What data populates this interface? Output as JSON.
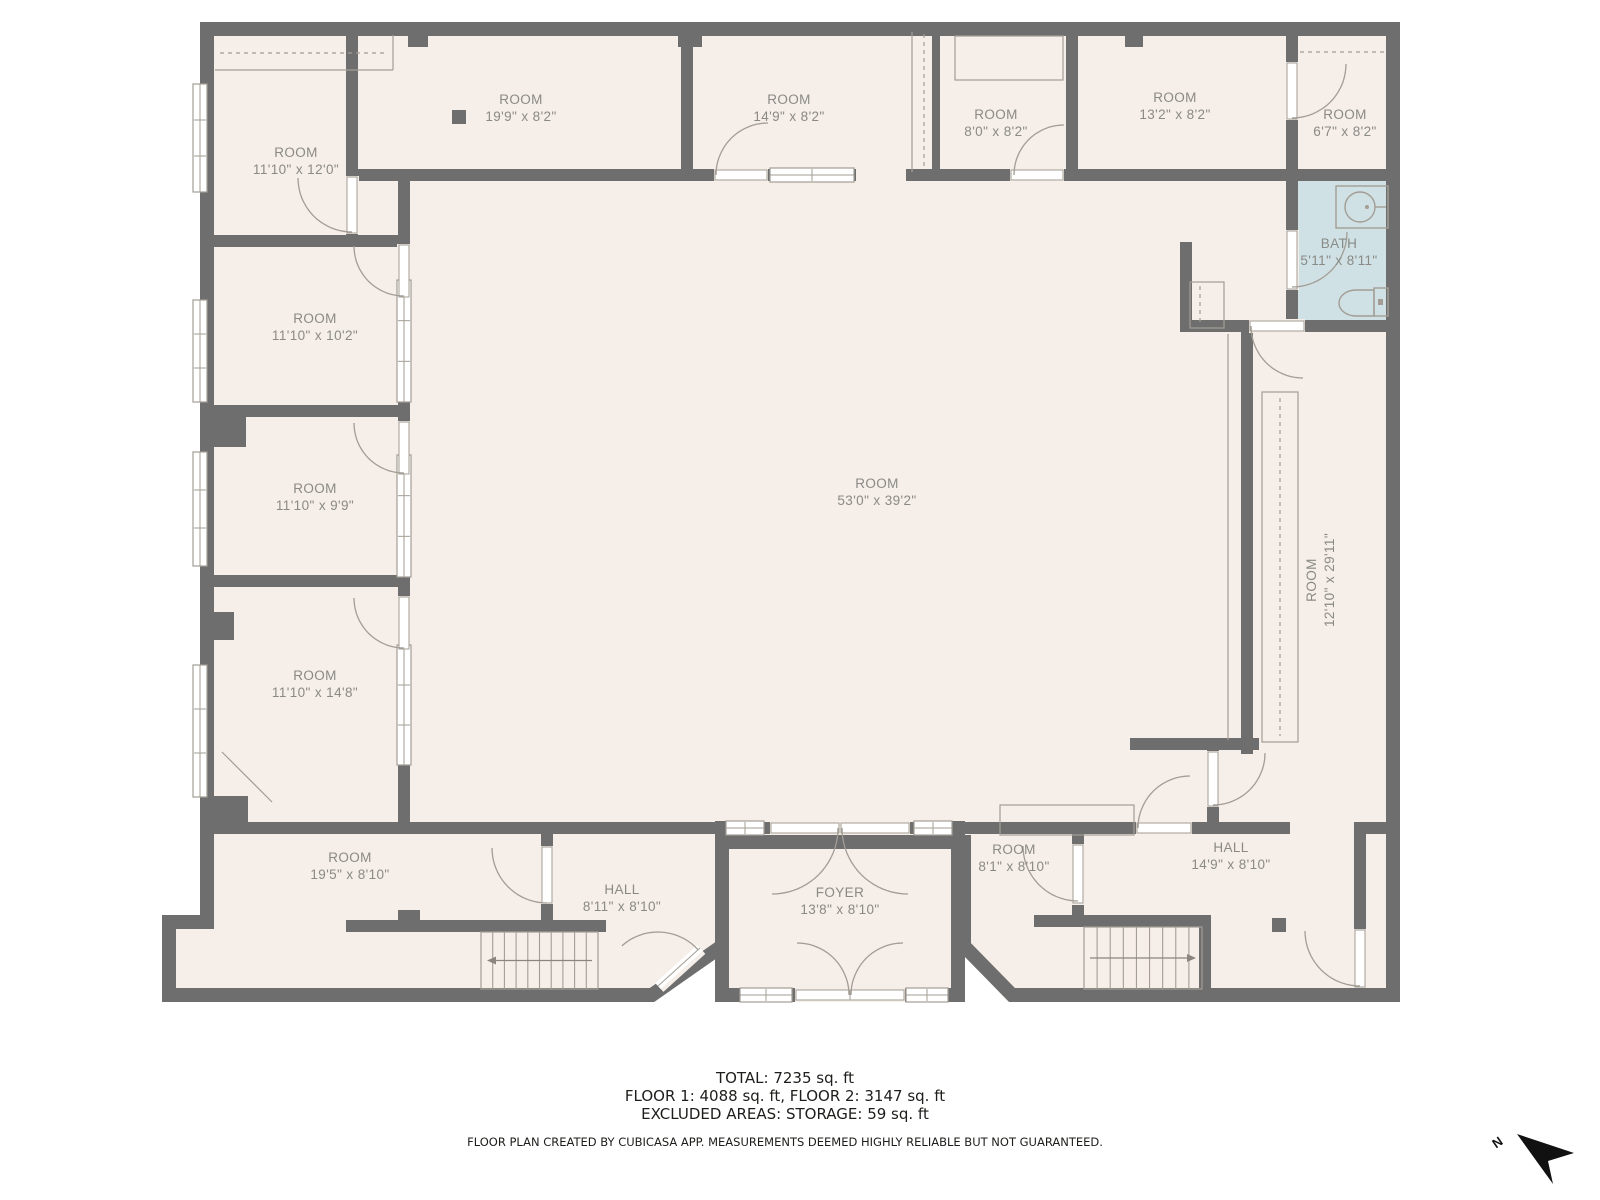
{
  "colors": {
    "wall": "#6e6e6e",
    "floor": "#f6eee8",
    "bath_floor": "#cfe1e4",
    "symbol_line": "#a39d95",
    "label_text": "#8a8a86",
    "footer_text": "#1d1d1b"
  },
  "rooms": [
    {
      "name": "ROOM",
      "dims": "11'10\" x 12'0\""
    },
    {
      "name": "ROOM",
      "dims": "19'9\" x 8'2\""
    },
    {
      "name": "ROOM",
      "dims": "14'9\" x 8'2\""
    },
    {
      "name": "ROOM",
      "dims": "8'0\" x 8'2\""
    },
    {
      "name": "ROOM",
      "dims": "13'2\" x 8'2\""
    },
    {
      "name": "ROOM",
      "dims": "6'7\" x 8'2\""
    },
    {
      "name": "BATH",
      "dims": "5'11\" x 8'11\""
    },
    {
      "name": "ROOM",
      "dims": "11'10\" x 10'2\""
    },
    {
      "name": "ROOM",
      "dims": "11'10\" x 9'9\""
    },
    {
      "name": "ROOM",
      "dims": "11'10\" x 14'8\""
    },
    {
      "name": "ROOM",
      "dims": "53'0\" x 39'2\""
    },
    {
      "name": "ROOM",
      "dims": "12'10\" x 29'11\""
    },
    {
      "name": "ROOM",
      "dims": "19'5\" x 8'10\""
    },
    {
      "name": "HALL",
      "dims": "8'11\" x 8'10\""
    },
    {
      "name": "FOYER",
      "dims": "13'8\" x 8'10\""
    },
    {
      "name": "ROOM",
      "dims": "8'1\" x 8'10\""
    },
    {
      "name": "HALL",
      "dims": "14'9\" x 8'10\""
    }
  ],
  "summary": {
    "total": "TOTAL: 7235 sq. ft",
    "floors": "FLOOR 1: 4088 sq. ft, FLOOR 2: 3147 sq. ft",
    "excluded": "EXCLUDED AREAS: STORAGE: 59 sq. ft"
  },
  "disclaimer": "FLOOR PLAN CREATED BY CUBICASA APP. MEASUREMENTS DEEMED HIGHLY RELIABLE BUT NOT GUARANTEED.",
  "compass": {
    "label": "N"
  }
}
